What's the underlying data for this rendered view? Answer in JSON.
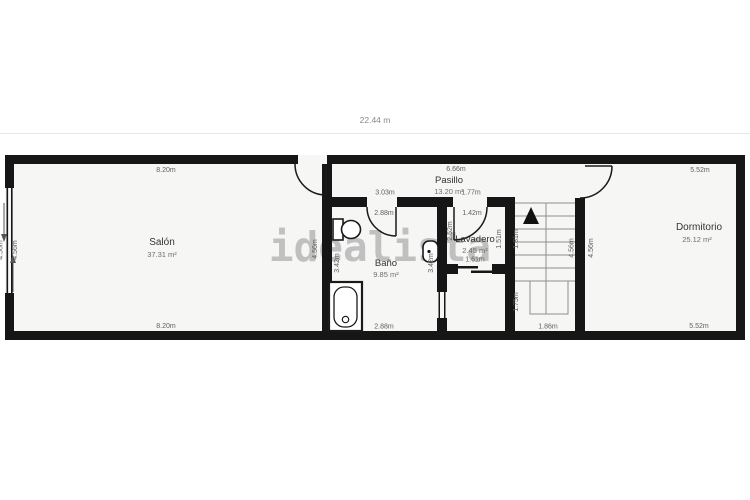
{
  "header": {
    "total_width": "22.44 m"
  },
  "watermark": "idealista",
  "rooms": {
    "salon": {
      "name": "Salón",
      "area": "37.31 m²"
    },
    "pasillo": {
      "name": "Pasillo",
      "area": "13.20 m²"
    },
    "bano": {
      "name": "Baño",
      "area": "9.85 m²"
    },
    "lavadero": {
      "name": "Lavadero",
      "area": "2.45 m²"
    },
    "dormitorio": {
      "name": "Dormitorio",
      "area": "25.12 m²"
    }
  },
  "dimensions": {
    "salon_top": "8.20m",
    "salon_bottom": "8.20m",
    "salon_window_outer": "4.56m",
    "salon_window_inner": "4.56m",
    "salon_right": "4.56m",
    "pasillo_top": "6.66m",
    "bano_top_outer": "3.03m",
    "bano_top_inner": "2.88m",
    "bano_bottom": "2.88m",
    "bano_left": "3.42m",
    "bano_right": "3.42m",
    "lavadero_top_outer": "1.77m",
    "lavadero_top_inner": "1.42m",
    "lavadero_left": "2.52m",
    "lavadero_right": "1.51m",
    "lavadero_bottom": "1.61m",
    "stairs_upper": "1.81m",
    "stairs_lower": "1.75m",
    "stairs_bottom": "1.86m",
    "stairs_right": "4.56m",
    "dormitorio_left": "4.56m",
    "dormitorio_top": "5.52m",
    "dormitorio_bottom": "5.52m"
  },
  "colors": {
    "wall": "#161616",
    "floor": "#f6f6f5",
    "divider": "#e6e6e6",
    "watermark": "#b7b7b7",
    "dimension_text": "#5e5e5e"
  }
}
